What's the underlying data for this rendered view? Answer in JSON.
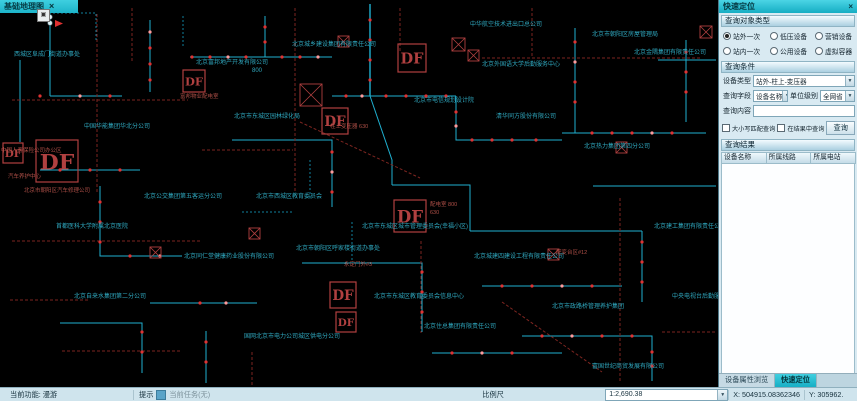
{
  "window": {
    "map_tab_label": "基础地理图",
    "map_tab_close": "×",
    "map_icon_glyph": "▣"
  },
  "panel": {
    "title": "快速定位",
    "close": "×",
    "section_object_type": "查询对象类型",
    "section_condition": "查询条件",
    "section_result": "查询结果",
    "radios": [
      {
        "label": "站外一次",
        "checked": true
      },
      {
        "label": "低压设备",
        "checked": false
      },
      {
        "label": "营销设备",
        "checked": false
      },
      {
        "label": "站内一次",
        "checked": false
      },
      {
        "label": "公用设备",
        "checked": false
      },
      {
        "label": "虚拟容器",
        "checked": false
      }
    ],
    "device_type_label": "设备类型",
    "device_type_value": "站外-柱上-变压器",
    "query_field_label": "查询字段",
    "query_field_value": "设备名称",
    "unit_level_label": "单位级别",
    "unit_level_value": "全网省",
    "query_content_label": "查询内容",
    "query_content_value": "",
    "checkbox_match": "大小写匹配查询",
    "checkbox_in_result": "在结果中查询",
    "query_button": "查询",
    "result_columns": [
      "设备名称",
      "所属线路",
      "所属电站"
    ],
    "bottom_tabs": [
      {
        "label": "设备属性浏览",
        "active": false
      },
      {
        "label": "快速定位",
        "active": true
      }
    ],
    "dropdown_arrow": "▼"
  },
  "statusbar": {
    "current_function": "当前功能: 漫游",
    "hint_label": "提示",
    "hint_value": "当前任务(无)",
    "scale_label": "比例尺",
    "scale_value": "1:2,690.38",
    "x_value": "X: 504915.08362346",
    "y_value": "Y: 305962.",
    "dropdown_arrow": "▼"
  },
  "map": {
    "df_label": "DF",
    "colors": {
      "cyan": "#1fb0d0",
      "cyan_dim": "#11809c",
      "red": "#7d2520",
      "dot": "#e03232",
      "dot_hi": "#ff9a9a",
      "df": "#b04040",
      "label": "#2fa8bf",
      "red_label": "#b05048",
      "white_dot": "#dceef2"
    },
    "lines": [
      {
        "c": "cyan",
        "p": "50,12 50,96"
      },
      {
        "c": "cyan",
        "p": "50,96 122,96"
      },
      {
        "c": "cyan",
        "p": "150,20 150,92"
      },
      {
        "c": "cyan",
        "p": "190,57 265,57 265,16"
      },
      {
        "c": "cyan",
        "p": "265,57 332,57"
      },
      {
        "c": "cyan",
        "p": "370,4 370,96",
        "w": 1.4
      },
      {
        "c": "cyan",
        "p": "370,96 392,160 392,185"
      },
      {
        "c": "cyan",
        "p": "332,96 456,96"
      },
      {
        "c": "cyan",
        "p": "456,96 456,140 562,140"
      },
      {
        "c": "cyan",
        "p": "562,133 706,133"
      },
      {
        "c": "cyan",
        "p": "575,28 575,133"
      },
      {
        "c": "cyan",
        "p": "232,140 332,140 332,207"
      },
      {
        "c": "cyan",
        "p": "40,170 140,170"
      },
      {
        "c": "cyan",
        "p": "100,186 100,256 182,256"
      },
      {
        "c": "cyan",
        "p": "392,185 470,185 470,231"
      },
      {
        "c": "cyan",
        "p": "470,231 642,231"
      },
      {
        "c": "cyan",
        "p": "642,231 642,302"
      },
      {
        "c": "cyan",
        "p": "302,263 422,263 422,332"
      },
      {
        "c": "cyan",
        "p": "482,286 622,286"
      },
      {
        "c": "cyan",
        "p": "150,303 257,303"
      },
      {
        "c": "cyan",
        "p": "60,323 142,323 142,373"
      },
      {
        "c": "cyan",
        "p": "522,336 652,336 652,381"
      },
      {
        "c": "cyan",
        "p": "686,40 686,122"
      },
      {
        "c": "cyan",
        "p": "432,353 562,353"
      },
      {
        "c": "cyan",
        "p": "206,331 206,383"
      },
      {
        "c": "cyan",
        "p": "20,60 20,142"
      },
      {
        "c": "cyan",
        "p": "593,186 716,186"
      },
      {
        "c": "cyan",
        "p": "658,60 716,60"
      },
      {
        "c": "cyan_dim",
        "p": "53,13 96,13 96,42",
        "d": "2,2"
      },
      {
        "c": "cyan_dim",
        "p": "183,16 183,46",
        "d": "2,2"
      },
      {
        "c": "cyan_dim",
        "p": "352,222 352,262",
        "d": "2,2"
      },
      {
        "c": "cyan_dim",
        "p": "242,212 292,212",
        "d": "2,2"
      },
      {
        "c": "cyan_dim",
        "p": "310,160 310,200",
        "d": "2,2"
      },
      {
        "c": "red",
        "p": "97,14 97,192",
        "d": "3,2"
      },
      {
        "c": "red",
        "p": "132,8 132,62",
        "d": "3,2"
      },
      {
        "c": "red",
        "p": "295,8 295,192",
        "d": "3,2"
      },
      {
        "c": "red",
        "p": "400,8 400,52",
        "d": "3,2"
      },
      {
        "c": "red",
        "p": "12,100 188,100",
        "d": "3,2"
      },
      {
        "c": "red",
        "p": "12,241 200,241",
        "d": "3,2"
      },
      {
        "c": "red",
        "p": "421,241 421,333",
        "d": "3,2"
      },
      {
        "c": "red",
        "p": "620,198 620,381",
        "d": "3,2"
      },
      {
        "c": "red",
        "p": "482,58 700,58",
        "d": "3,2"
      },
      {
        "c": "red",
        "p": "300,122 420,178",
        "d": "3,2"
      },
      {
        "c": "red",
        "p": "202,150 293,150",
        "d": "3,2"
      },
      {
        "c": "red",
        "p": "502,302 602,372",
        "d": "3,2"
      },
      {
        "c": "red",
        "p": "62,351 182,351",
        "d": "3,2"
      },
      {
        "c": "red",
        "p": "252,352 252,386",
        "d": "3,2"
      },
      {
        "c": "red",
        "p": "532,8 532,56",
        "d": "3,2"
      },
      {
        "c": "red",
        "p": "662,332 716,332",
        "d": "3,2"
      },
      {
        "c": "red",
        "p": "10,300 90,300",
        "d": "3,2"
      }
    ],
    "dots": [
      [
        150,
        32
      ],
      [
        150,
        48
      ],
      [
        150,
        64
      ],
      [
        150,
        80
      ],
      [
        192,
        57
      ],
      [
        210,
        57
      ],
      [
        228,
        57
      ],
      [
        246,
        57
      ],
      [
        265,
        42
      ],
      [
        265,
        27
      ],
      [
        282,
        57
      ],
      [
        300,
        57
      ],
      [
        318,
        57
      ],
      [
        370,
        20
      ],
      [
        370,
        40
      ],
      [
        370,
        60
      ],
      [
        370,
        80
      ],
      [
        346,
        96
      ],
      [
        362,
        96
      ],
      [
        386,
        96
      ],
      [
        406,
        96
      ],
      [
        426,
        96
      ],
      [
        446,
        96
      ],
      [
        456,
        112
      ],
      [
        456,
        126
      ],
      [
        472,
        140
      ],
      [
        492,
        140
      ],
      [
        512,
        140
      ],
      [
        536,
        140
      ],
      [
        575,
        42
      ],
      [
        575,
        62
      ],
      [
        575,
        82
      ],
      [
        575,
        102
      ],
      [
        592,
        133
      ],
      [
        612,
        133
      ],
      [
        632,
        133
      ],
      [
        652,
        133
      ],
      [
        672,
        133
      ],
      [
        686,
        52
      ],
      [
        686,
        72
      ],
      [
        686,
        92
      ],
      [
        332,
        152
      ],
      [
        332,
        172
      ],
      [
        332,
        192
      ],
      [
        100,
        202
      ],
      [
        100,
        222
      ],
      [
        100,
        242
      ],
      [
        130,
        256
      ],
      [
        160,
        256
      ],
      [
        422,
        272
      ],
      [
        422,
        292
      ],
      [
        422,
        312
      ],
      [
        502,
        286
      ],
      [
        532,
        286
      ],
      [
        562,
        286
      ],
      [
        592,
        286
      ],
      [
        642,
        242
      ],
      [
        642,
        262
      ],
      [
        642,
        282
      ],
      [
        200,
        303
      ],
      [
        226,
        303
      ],
      [
        142,
        332
      ],
      [
        142,
        352
      ],
      [
        206,
        342
      ],
      [
        206,
        362
      ],
      [
        542,
        336
      ],
      [
        572,
        336
      ],
      [
        602,
        336
      ],
      [
        632,
        336
      ],
      [
        652,
        352
      ],
      [
        652,
        366
      ],
      [
        452,
        353
      ],
      [
        482,
        353
      ],
      [
        512,
        353
      ],
      [
        60,
        170
      ],
      [
        90,
        170
      ],
      [
        120,
        170
      ],
      [
        40,
        96
      ],
      [
        80,
        96
      ],
      [
        110,
        96
      ]
    ],
    "white_dots": [
      [
        50,
        17
      ],
      [
        50,
        23
      ]
    ],
    "arrows": [
      {
        "points": "55,20 63,23.5 55,27"
      }
    ],
    "df_boxes": [
      {
        "x": 183,
        "y": 70,
        "s": 22
      },
      {
        "x": 398,
        "y": 44,
        "s": 28
      },
      {
        "x": 36,
        "y": 140,
        "s": 42
      },
      {
        "x": 3,
        "y": 143,
        "s": 20
      },
      {
        "x": 322,
        "y": 108,
        "s": 26
      },
      {
        "x": 394,
        "y": 200,
        "s": 32
      },
      {
        "x": 330,
        "y": 282,
        "s": 26
      },
      {
        "x": 336,
        "y": 312,
        "s": 20
      }
    ],
    "cross_boxes": [
      {
        "x": 452,
        "y": 38,
        "s": 13
      },
      {
        "x": 468,
        "y": 50,
        "s": 11
      },
      {
        "x": 300,
        "y": 84,
        "s": 22
      },
      {
        "x": 249,
        "y": 228,
        "s": 11
      },
      {
        "x": 548,
        "y": 249,
        "s": 11
      },
      {
        "x": 150,
        "y": 247,
        "s": 11
      },
      {
        "x": 616,
        "y": 142,
        "s": 11
      },
      {
        "x": 700,
        "y": 26,
        "s": 12
      },
      {
        "x": 338,
        "y": 36,
        "s": 11
      }
    ],
    "labels": [
      {
        "x": 196,
        "y": 64,
        "t": "北京富邦地产开发有限公司"
      },
      {
        "x": 252,
        "y": 72,
        "t": "800"
      },
      {
        "x": 292,
        "y": 46,
        "t": "北京城乡建设集团有限责任公司"
      },
      {
        "x": 470,
        "y": 26,
        "t": "中华航空技术进出口总公司"
      },
      {
        "x": 592,
        "y": 36,
        "t": "北京市朝阳区房屋管理局"
      },
      {
        "x": 634,
        "y": 54,
        "t": "北京金隅集团有限责任公司"
      },
      {
        "x": 414,
        "y": 102,
        "t": "北京市电信规划设计院"
      },
      {
        "x": 496,
        "y": 118,
        "t": "清华同方股份有限公司"
      },
      {
        "x": 584,
        "y": 148,
        "t": "北京热力集团第四分公司"
      },
      {
        "x": 234,
        "y": 118,
        "t": "北京市东城区园林绿化局"
      },
      {
        "x": 84,
        "y": 128,
        "t": "中国华能集团华北分公司"
      },
      {
        "x": 144,
        "y": 198,
        "t": "北京公交集团第五客运分公司"
      },
      {
        "x": 256,
        "y": 198,
        "t": "北京市西城区教育委员会"
      },
      {
        "x": 362,
        "y": 228,
        "t": "北京市东城区城市管理委员会(幸福小区)"
      },
      {
        "x": 56,
        "y": 228,
        "t": "首都医科大学附属北京医院"
      },
      {
        "x": 184,
        "y": 258,
        "t": "北京同仁堂健康药业股份有限公司"
      },
      {
        "x": 296,
        "y": 250,
        "t": "北京市朝阳区呼家楼街道办事处"
      },
      {
        "x": 474,
        "y": 258,
        "t": "北京城建四建设工程有限责任公司"
      },
      {
        "x": 552,
        "y": 308,
        "t": "北京市政路桥管理养护集团"
      },
      {
        "x": 374,
        "y": 298,
        "t": "北京市东城区教育委员会信息中心"
      },
      {
        "x": 424,
        "y": 328,
        "t": "北京住总集团有限责任公司"
      },
      {
        "x": 244,
        "y": 338,
        "t": "国网北京市电力公司城区供电分公司"
      },
      {
        "x": 74,
        "y": 298,
        "t": "北京自来水集团第二分公司"
      },
      {
        "x": 592,
        "y": 368,
        "t": "富国世纪商贸发展有限公司"
      },
      {
        "x": 654,
        "y": 228,
        "t": "北京建工集团有限责任公司"
      },
      {
        "x": 672,
        "y": 298,
        "t": "中央电视台后勤服务中心"
      },
      {
        "x": 482,
        "y": 66,
        "t": "北京外国语大学后勤服务中心"
      },
      {
        "x": 14,
        "y": 56,
        "t": "西城区阜成门街道办事处"
      }
    ],
    "red_labels": [
      {
        "x": 1,
        "y": 152,
        "t": "中国人寿保险公司办公区"
      },
      {
        "x": 8,
        "y": 178,
        "t": "汽车养护中心"
      },
      {
        "x": 24,
        "y": 192,
        "t": "北京市朝阳区汽车修理公司"
      },
      {
        "x": 180,
        "y": 98,
        "t": "富邦物业配电室"
      },
      {
        "x": 430,
        "y": 206,
        "t": "配电室 800"
      },
      {
        "x": 430,
        "y": 214,
        "t": "630"
      },
      {
        "x": 330,
        "y": 128,
        "t": "柱上变压器 630"
      },
      {
        "x": 556,
        "y": 254,
        "t": "配变台区#12"
      },
      {
        "x": 344,
        "y": 266,
        "t": "永定门外#3"
      }
    ]
  }
}
